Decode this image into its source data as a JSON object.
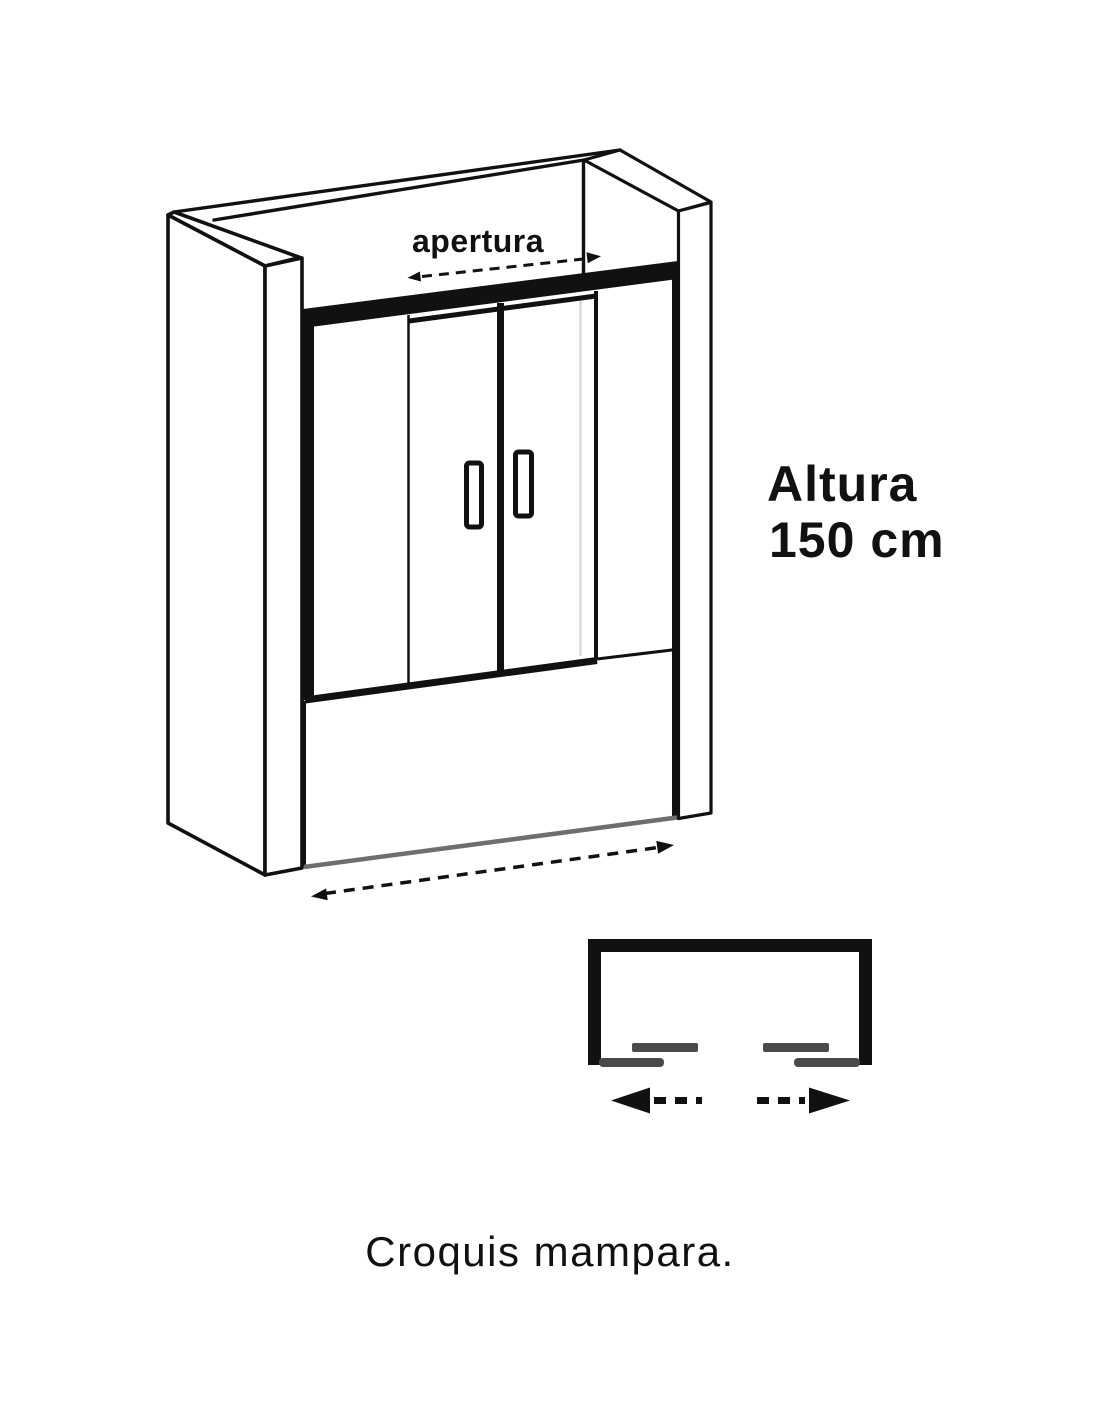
{
  "diagram": {
    "opening_label": "apertura",
    "height_label": {
      "line1": "Altura",
      "line2": "150 cm"
    }
  },
  "caption": "Croquis mampara.",
  "colors": {
    "background": "#ffffff",
    "ink": "#111111",
    "glass_fill": "#ffffff",
    "tub_edge_gray": "#6e6e6e",
    "wall_hint_gray": "#d9d9d9",
    "panel_gray": "#4a4a4a"
  },
  "icons": {
    "opening_arrow": "dashed-double-headed-arrow",
    "width_arrow": "dashed-double-headed-arrow",
    "slide_left_arrow": "bold-dashed-arrow-left",
    "slide_right_arrow": "bold-dashed-arrow-right"
  }
}
